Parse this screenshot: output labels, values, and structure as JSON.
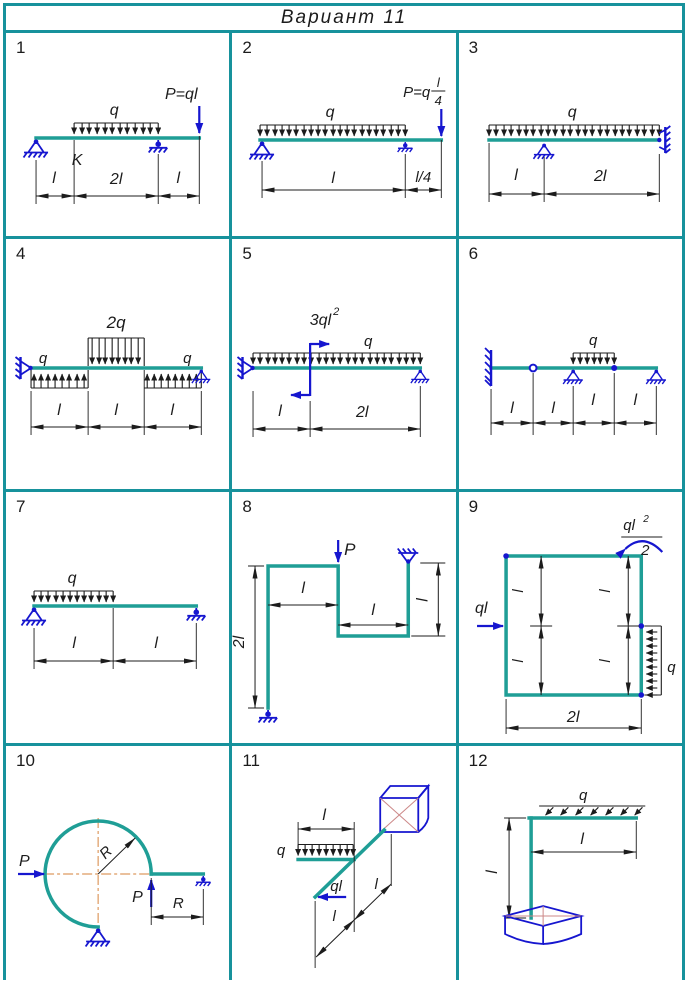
{
  "header": {
    "title": "Вариант  11"
  },
  "colors": {
    "grid": "#17929c",
    "beam": "#1f9e96",
    "support": "#1616cf",
    "ink": "#1c1c1c",
    "centerline": "#de9a60",
    "facet": "#cc8888"
  },
  "cells": [
    {
      "number": "1",
      "q": "q",
      "force": "P=ql",
      "k": "K",
      "d1": "l",
      "d2": "2l",
      "d3": "l"
    },
    {
      "number": "2",
      "q": "q",
      "force_prefix": "P=q",
      "frac_num": "l",
      "frac_den": "4",
      "d1": "l",
      "d2": "l/4"
    },
    {
      "number": "3",
      "q": "q",
      "d1": "l",
      "d2": "2l"
    },
    {
      "number": "4",
      "q_left": "q",
      "q_mid": "2q",
      "q_right": "q",
      "d1": "l",
      "d2": "l",
      "d3": "l"
    },
    {
      "number": "5",
      "moment": "3ql",
      "moment_exp": "2",
      "q": "q",
      "d1": "l",
      "d2": "2l"
    },
    {
      "number": "6",
      "q": "q",
      "d1": "l",
      "d2": "l",
      "d3": "l",
      "d4": "l"
    },
    {
      "number": "7",
      "q": "q",
      "d1": "l",
      "d2": "l"
    },
    {
      "number": "8",
      "force": "P",
      "d_left": "2l",
      "d_top": "l",
      "d_bot": "l",
      "d_right": "l"
    },
    {
      "number": "9",
      "force": "ql",
      "m_num": "ql",
      "m_exp": "2",
      "m_den": "2",
      "q": "q",
      "d_bot": "2l",
      "l1": "l",
      "l2": "l",
      "l3": "l",
      "l4": "l"
    },
    {
      "number": "10",
      "p_h": "P",
      "p_v": "P",
      "r": "R",
      "d_r": "R"
    },
    {
      "number": "11",
      "q": "q",
      "force": "ql",
      "d_top": "l",
      "d1": "l",
      "d2": "l"
    },
    {
      "number": "12",
      "q": "q",
      "d_h": "l",
      "d_v": "l"
    }
  ]
}
